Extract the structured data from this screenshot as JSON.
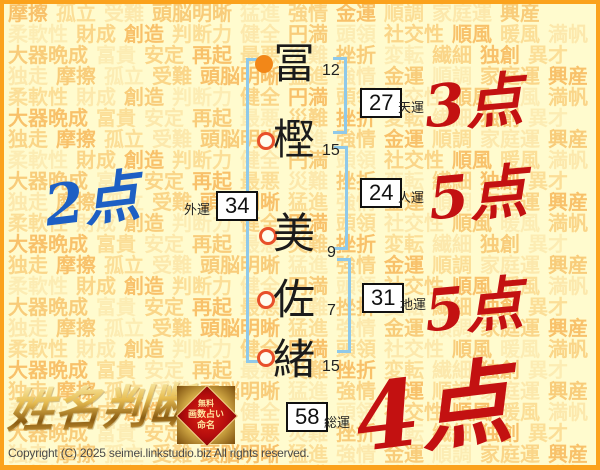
{
  "watermark": {
    "words": [
      "摩擦",
      "孤立",
      "受難",
      "頭脳明晰",
      "猛進",
      "強情",
      "金運",
      "順調",
      "家庭運",
      "興産",
      "柔軟性",
      "財成",
      "創造",
      "判断力",
      "健全",
      "円満",
      "頭領",
      "社交性",
      "順風",
      "暖風",
      "満帆",
      "大器晩成",
      "富貴",
      "安定",
      "再起",
      "最悪",
      "災難",
      "挫折",
      "変転",
      "繊細",
      "独創",
      "異才",
      "独走"
    ],
    "palette": [
      "rgba(243,155,40,0.60)",
      "rgba(246,186,85,0.45)",
      "rgba(248,206,122,0.40)",
      "rgba(242,166,52,0.55)",
      "rgba(249,215,142,0.42)",
      "rgba(245,176,66,0.50)"
    ]
  },
  "name": {
    "chars": [
      {
        "char": "冨",
        "strokes": "12"
      },
      {
        "char": "樫",
        "strokes": "15"
      },
      {
        "char": "美",
        "strokes": "9"
      },
      {
        "char": "佐",
        "strokes": "7"
      },
      {
        "char": "緒",
        "strokes": "15"
      }
    ]
  },
  "fortunes": {
    "tenun": {
      "value": "27",
      "label": "天運"
    },
    "jinun": {
      "value": "24",
      "label": "人運"
    },
    "chiun": {
      "value": "31",
      "label": "地運"
    },
    "gaiun": {
      "value": "34",
      "label": "外運"
    },
    "souun": {
      "value": "58",
      "label": "総運"
    }
  },
  "scores": {
    "tenun": "3点",
    "jinun": "5点",
    "chiun": "5点",
    "gaiun": "2点",
    "souun": "4点"
  },
  "logo": {
    "title": "姓名判断",
    "badge": {
      "line1": "無料",
      "line2": "画数占い",
      "line3": "命名"
    }
  },
  "footer": {
    "copyright": "Copyright (C) 2025 seimei.linkstudio.biz All rights reserved."
  },
  "colors": {
    "background": "#FFFBCE",
    "frame_orange": "#FBA21C",
    "bracket_blue": "#8FC9E9",
    "score_red": "#C31111",
    "score_blue": "#1D5FC4",
    "bullet_orange": "#F28718",
    "bullet_ring": "#E8502A"
  }
}
